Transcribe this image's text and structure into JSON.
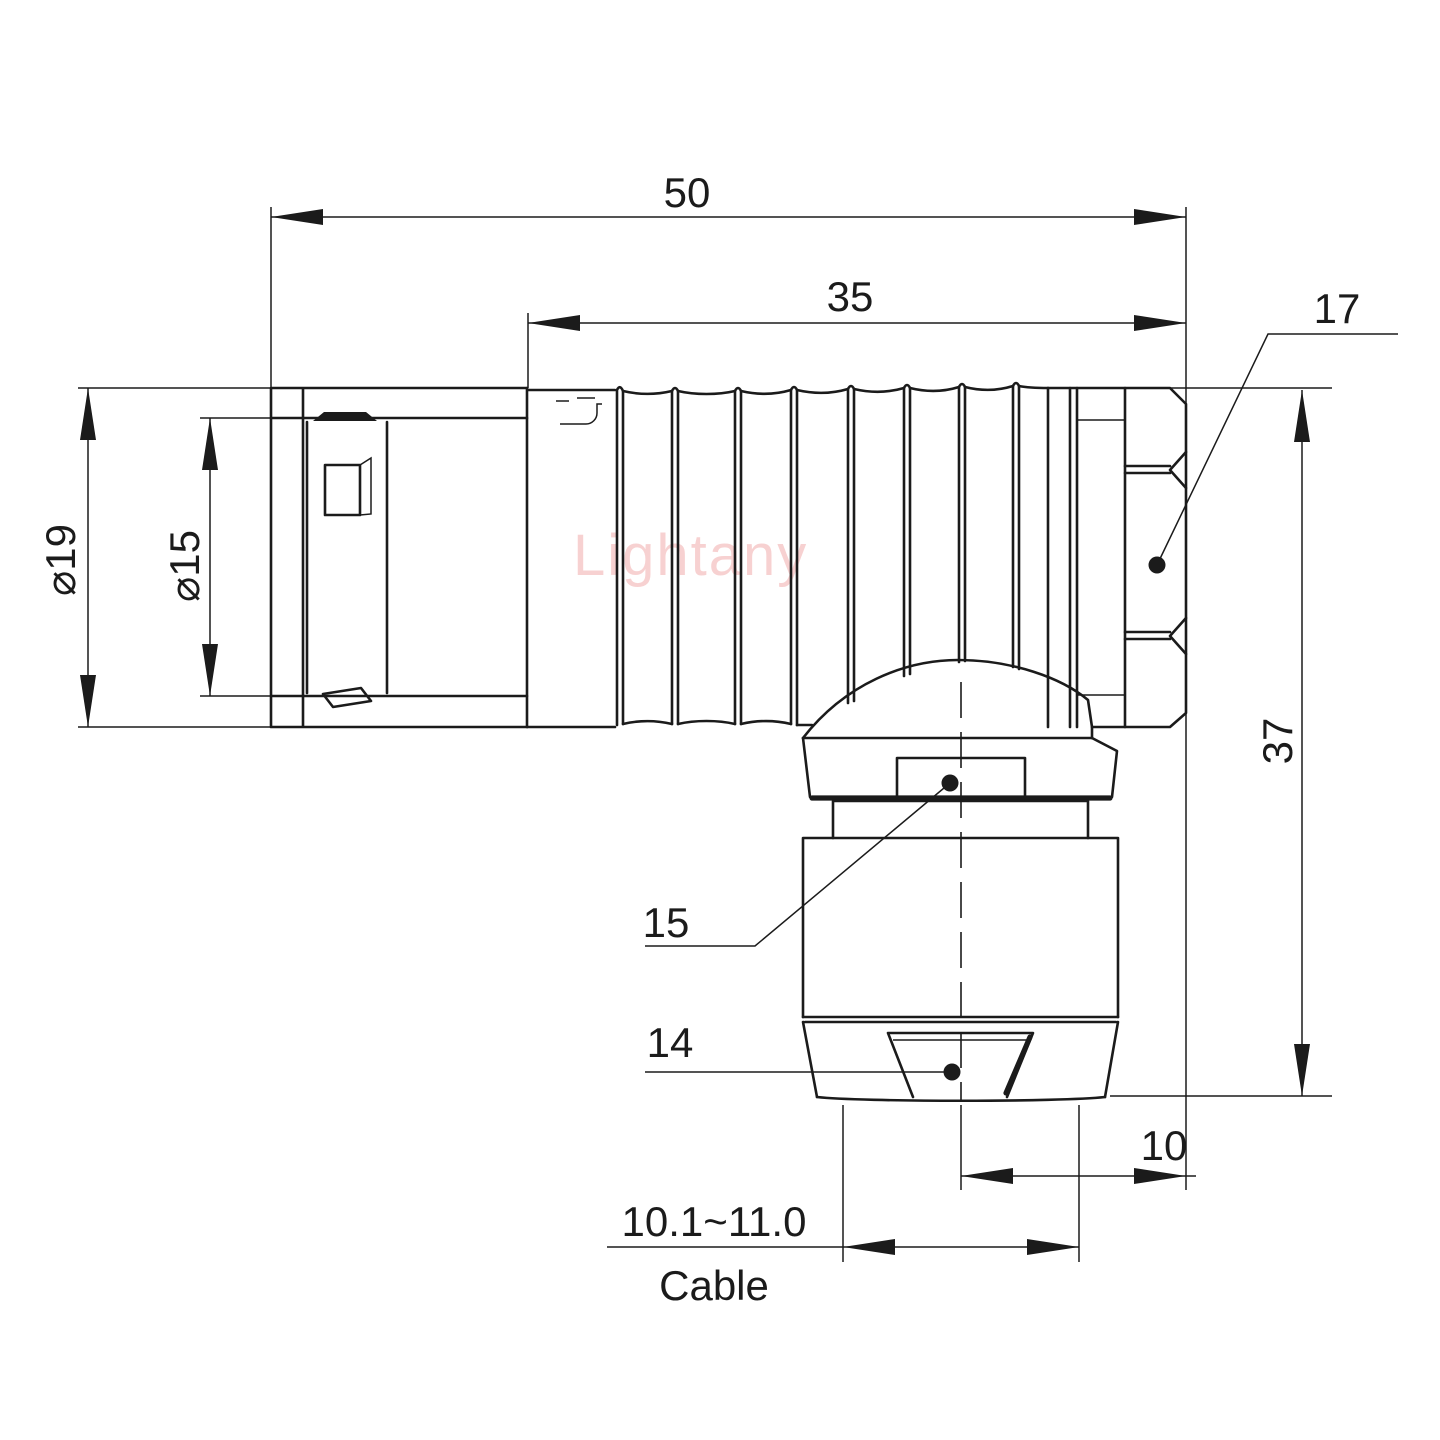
{
  "drawing": {
    "title": "right-angle-connector-dimensional-drawing",
    "watermark": "Lightany",
    "colors": {
      "line": "#1b1b1b",
      "watermark": "#f7cdcd",
      "background": "#ffffff"
    },
    "dimensions": {
      "total_length": "50",
      "body_length": "35",
      "nut_callout": "17",
      "outer_diameter": "⌀19",
      "inner_diameter": "⌀15",
      "overall_height": "37",
      "collar_callout": "15",
      "clamp_callout": "14",
      "axis_offset": "10",
      "cable_range": "10.1~11.0",
      "cable_label": "Cable"
    }
  }
}
